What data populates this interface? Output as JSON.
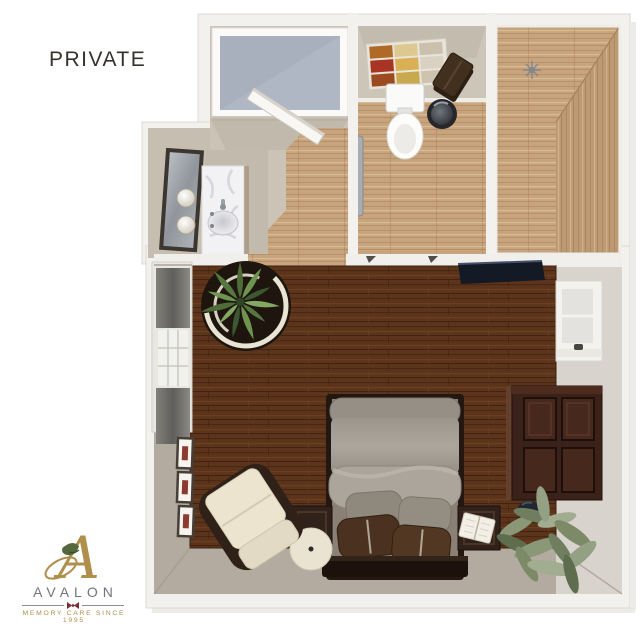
{
  "header": {
    "title": "PRIVATE",
    "title_color": "#35332c"
  },
  "logo": {
    "monogram": "A",
    "name": "AVALON",
    "tagline": "MEMORY CARE SINCE 1995",
    "colors": {
      "gold": "#b08e4c",
      "gray": "#70757b",
      "maroon": "#7c2d2d",
      "leaf_green": "#55683c"
    }
  },
  "floor_plan": {
    "label": "Private room 3D floor plan, top-down render",
    "colors": {
      "wall_white": "#f3f1ee",
      "wall_beige": "#cbc3b5",
      "wall_greige": "#b3ab9f",
      "floor_light_wood": "#c7a47d",
      "floor_dark_wood": "#5b341b",
      "shower_glass": "#a7b0bc",
      "marble_counter": "#f2f1f3",
      "bed_duvet": "#a49e95",
      "pillow_brown": "#4a3120",
      "furniture_dark_wood": "#3a211a",
      "plant_green": "#6f9450"
    },
    "rooms": [
      {
        "name": "entry-hall",
        "items": [
          "shower",
          "open-entry-door",
          "wood-floor"
        ]
      },
      {
        "name": "vanity-area",
        "items": [
          "wall-mirror",
          "sconce-lights",
          "marble-vanity-sink"
        ]
      },
      {
        "name": "bathroom",
        "items": [
          "storage-shelf",
          "folded-towels",
          "toilet",
          "trash-can",
          "grab-bar"
        ]
      },
      {
        "name": "walk-in-closet",
        "items": [
          "wood-floor",
          "ceiling-light"
        ]
      },
      {
        "name": "bedroom",
        "items": [
          "bed",
          "gray-pillows",
          "brown-pillows",
          "nightstand-left",
          "nightstand-right",
          "round-side-table",
          "armchair",
          "dresser",
          "wall-tv",
          "window-left",
          "window-right",
          "corner-potted-plant",
          "floor-plant",
          "framed-art-x3",
          "dark-vase",
          "book"
        ]
      }
    ]
  }
}
